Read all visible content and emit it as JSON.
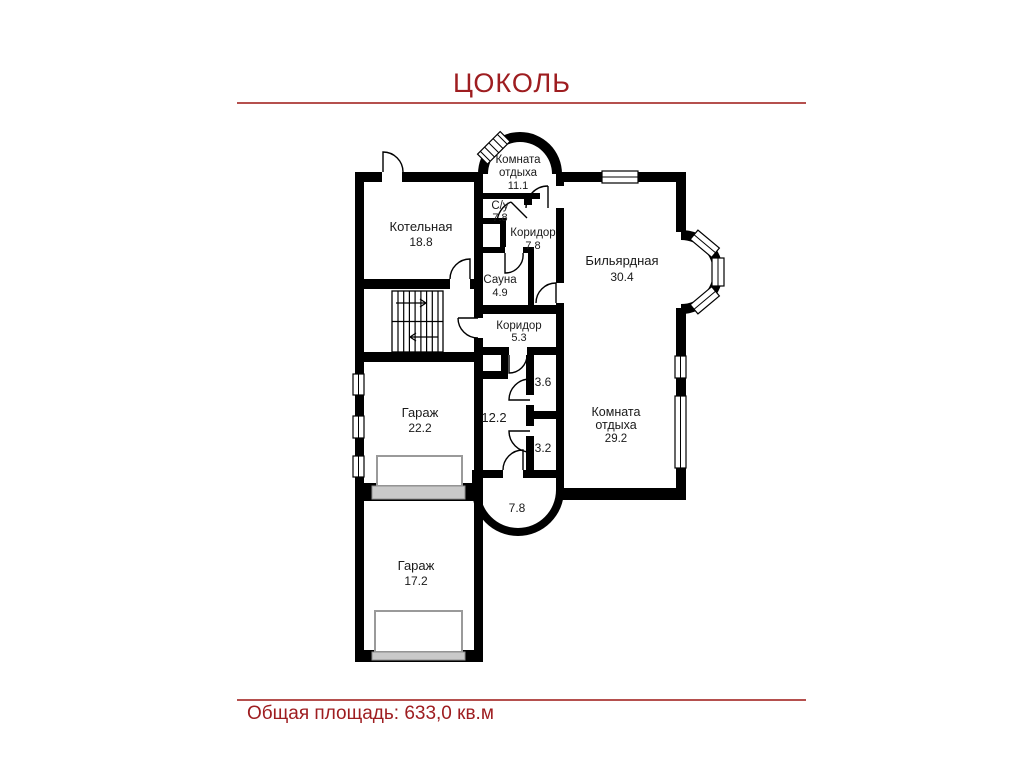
{
  "page": {
    "title": "ЦОКОЛЬ",
    "footer": "Общая площадь: 633,0 кв.м",
    "accent_color": "#9e1d20",
    "rule_color": "#b5504e",
    "wall_color": "#000000"
  },
  "plan": {
    "rooms": [
      {
        "id": "komnata-otdyha-verh",
        "lines": [
          "Комната",
          "отдыха"
        ],
        "area": "11.1"
      },
      {
        "id": "su",
        "lines": [
          "С/у"
        ],
        "area": "7.8"
      },
      {
        "id": "koridor-verh",
        "lines": [
          "Коридор"
        ],
        "area": "7.8"
      },
      {
        "id": "kotelnaya",
        "lines": [
          "Котельная"
        ],
        "area": "18.8"
      },
      {
        "id": "sauna",
        "lines": [
          "Сауна"
        ],
        "area": "4.9"
      },
      {
        "id": "bilyardnaya",
        "lines": [
          "Бильярдная"
        ],
        "area": "30.4"
      },
      {
        "id": "koridor-centr",
        "lines": [
          "Коридор"
        ],
        "area": "5.3"
      },
      {
        "id": "garazh-bolshoy",
        "lines": [
          "Гараж"
        ],
        "area": "22.2"
      },
      {
        "id": "pomeshchenie-12-2",
        "lines": [],
        "area": "12.2"
      },
      {
        "id": "pomeshchenie-3-6",
        "lines": [],
        "area": "3.6"
      },
      {
        "id": "pomeshchenie-3-2",
        "lines": [],
        "area": "3.2"
      },
      {
        "id": "komnata-otdyha-niz",
        "lines": [
          "Комната",
          "отдыха"
        ],
        "area": "29.2"
      },
      {
        "id": "pomeshchenie-7-8",
        "lines": [],
        "area": "7.8"
      },
      {
        "id": "garazh-malyy",
        "lines": [
          "Гараж"
        ],
        "area": "17.2"
      }
    ]
  }
}
